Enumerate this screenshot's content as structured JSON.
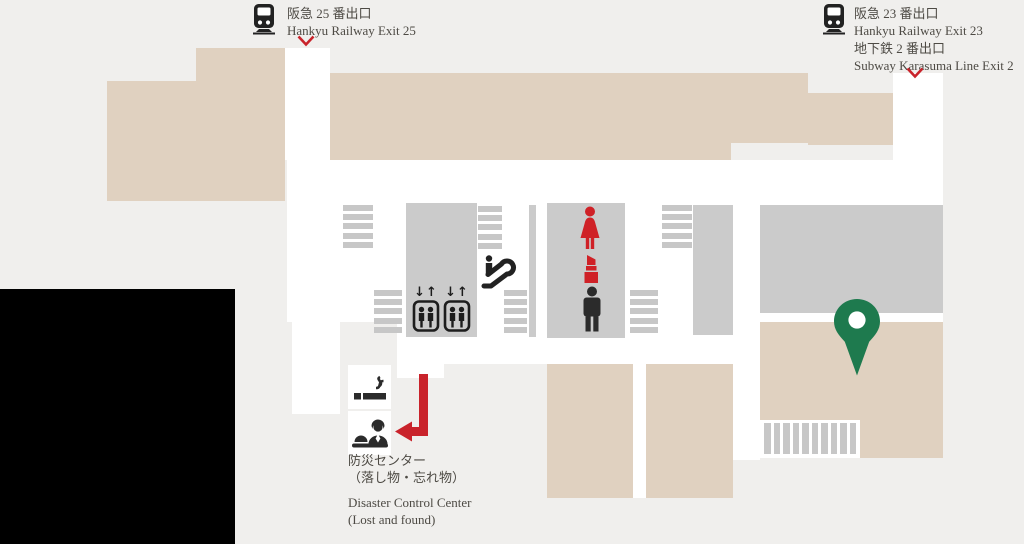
{
  "page": {
    "type": "station-floor-map"
  },
  "exits": {
    "hankyu25": {
      "jp": "阪急 25 番出口",
      "en": "Hankyu Railway Exit 25"
    },
    "hankyu23": {
      "jp": "阪急 23 番出口",
      "en": "Hankyu Railway Exit 23"
    },
    "subway2": {
      "jp": "地下鉄 2 番出口",
      "en": "Subway Karasuma Line Exit 2"
    }
  },
  "disaster_center": {
    "jp_line1": "防災センター",
    "jp_line2": "（落し物・忘れ物）",
    "en_line1": "Disaster Control Center",
    "en_line2": "(Lost and found)"
  },
  "elevator": {
    "arrows": "↓↑"
  },
  "icons": [
    "train-icon",
    "down-chevron-icon",
    "elevator-icon",
    "escalator-icon",
    "stairs-icon",
    "woman-restroom-icon",
    "cosmetics-icon",
    "man-restroom-icon",
    "smoking-area-icon",
    "reception-icon",
    "route-arrow-icon",
    "location-pin-icon"
  ],
  "colors": {
    "background": "#f0efed",
    "corridor_white": "#ffffff",
    "building_beige": "#e0d1c0",
    "structure_gray": "#cbcbcb",
    "stair_gray": "#c7c7c7",
    "accent_red": "#c9232b",
    "pin_green": "#1e7a4e",
    "icon_black": "#222222",
    "text": "#4d4a44"
  }
}
